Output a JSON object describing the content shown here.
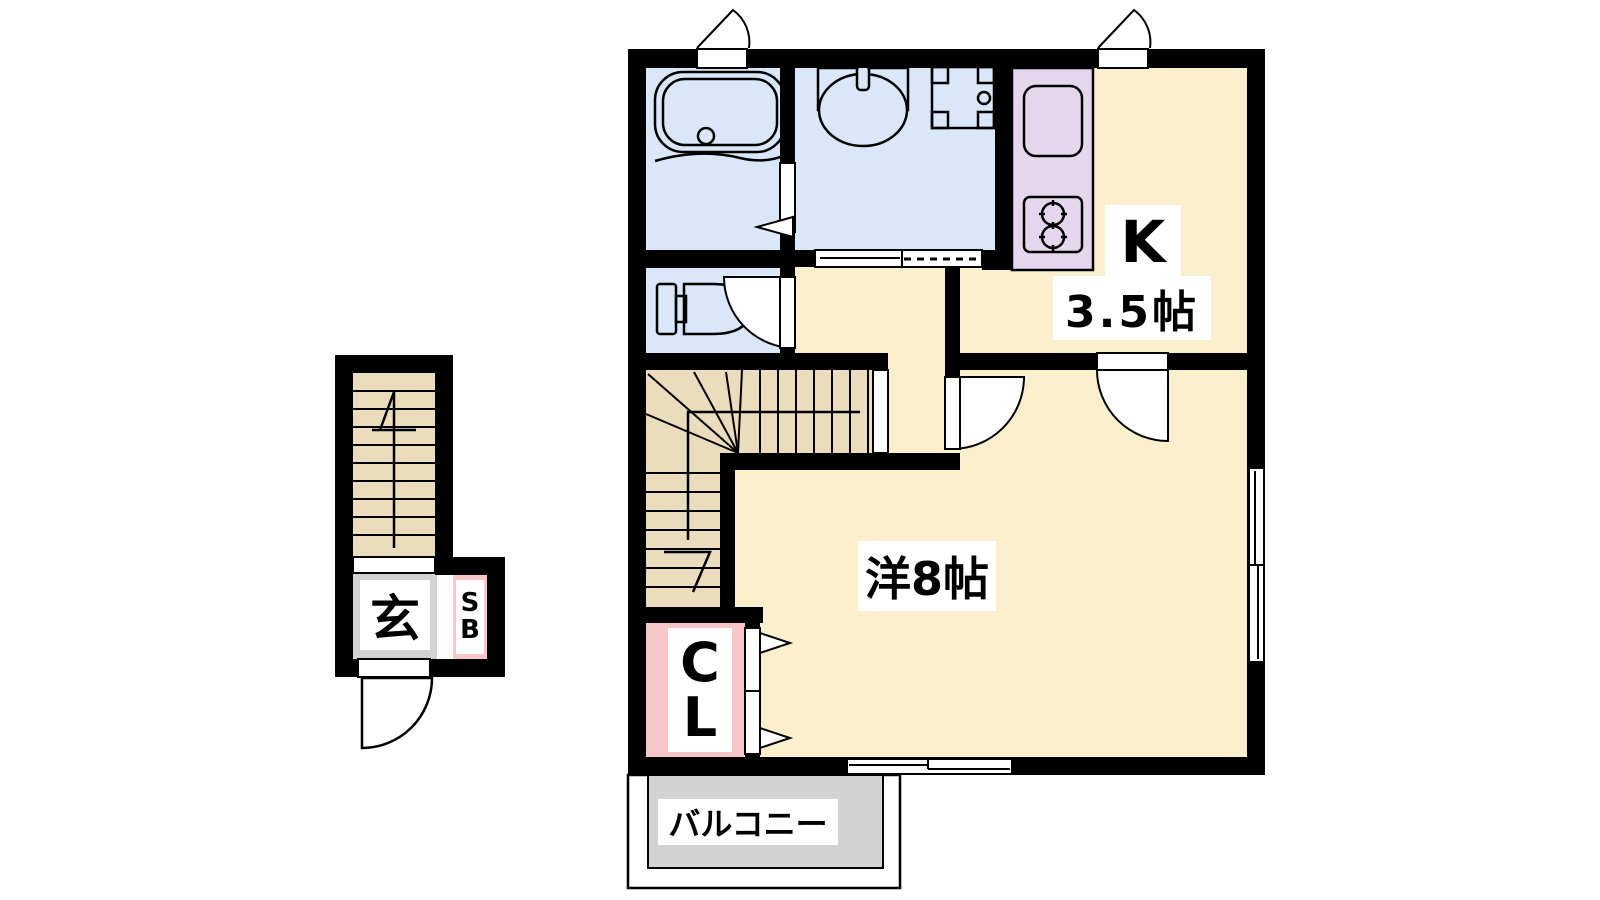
{
  "title": "apartment-floor-plan",
  "rooms": {
    "kitchen": {
      "label": "K",
      "size": "3.5帖"
    },
    "western": {
      "label": "洋8帖"
    },
    "closet": {
      "label": "CL"
    },
    "balcony": {
      "label": "バルコニー"
    },
    "entrance": {
      "label": "玄"
    },
    "shoe_box": {
      "label": "SB"
    }
  },
  "fixtures": {
    "bathtub": "bathtub-icon",
    "toilet": "toilet-icon",
    "washbasin": "washbasin-icon",
    "washing_machine_pan": "washing-machine-pan-icon",
    "kitchen_sink": "kitchen-sink-icon",
    "stove": "stove-burner-icon",
    "stairs_internal": "internal-staircase",
    "stairs_entrance": "entrance-staircase"
  },
  "colors": {
    "wall": "#000000",
    "floor_cream": "#FBEFCE",
    "stairs_tan": "#EADCBC",
    "water_blue": "#D9E7F8",
    "counter_purple": "#E5D6ED",
    "closet_pink": "#F9C6CA",
    "gray": "#D3D3D3",
    "white": "#FFFFFF"
  }
}
